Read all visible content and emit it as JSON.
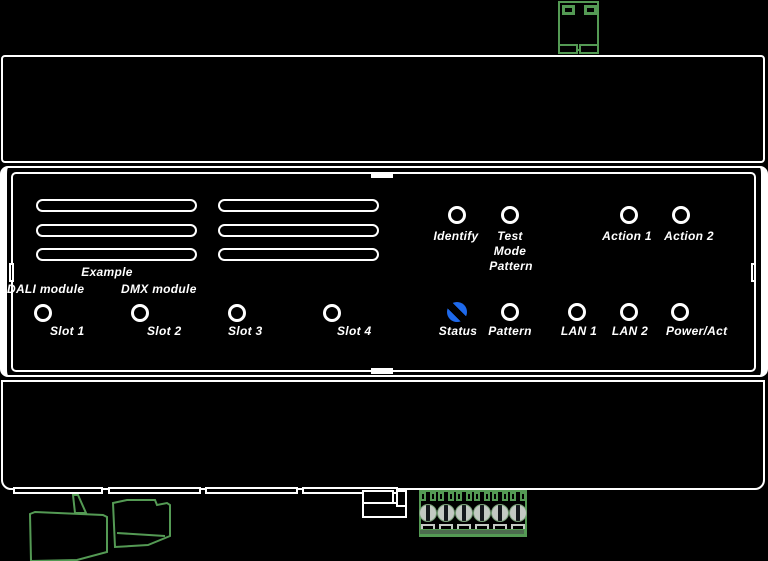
{
  "colors": {
    "background": "#000000",
    "line": "#ffffff",
    "green": "#549a54",
    "status_blue": "#1e69eb",
    "screw_gray": "#c3c9c3",
    "strip_green": "#4c6b4e"
  },
  "panel": {
    "example_label": "Example",
    "module_labels": [
      {
        "label": "DALI module"
      },
      {
        "label": "DMX module"
      }
    ],
    "slot_leds": [
      {
        "label": "Slot 1",
        "state": "off"
      },
      {
        "label": "Slot 2",
        "state": "off"
      },
      {
        "label": "Slot 3",
        "state": "off"
      },
      {
        "label": "Slot 4",
        "state": "off"
      }
    ],
    "top_leds": [
      {
        "label": "Identify",
        "state": "off"
      },
      {
        "label": "Test Mode Pattern",
        "lines": [
          "Test",
          "Mode",
          "Pattern"
        ],
        "state": "off"
      },
      {
        "label": "Action 1",
        "state": "off"
      },
      {
        "label": "Action 2",
        "state": "off"
      }
    ],
    "status_leds": [
      {
        "label": "Status",
        "state": "on-blue"
      },
      {
        "label": "Pattern",
        "state": "off"
      },
      {
        "label": "LAN 1",
        "state": "off"
      },
      {
        "label": "LAN 2",
        "state": "off"
      },
      {
        "label": "Power/Act",
        "state": "off"
      }
    ]
  }
}
